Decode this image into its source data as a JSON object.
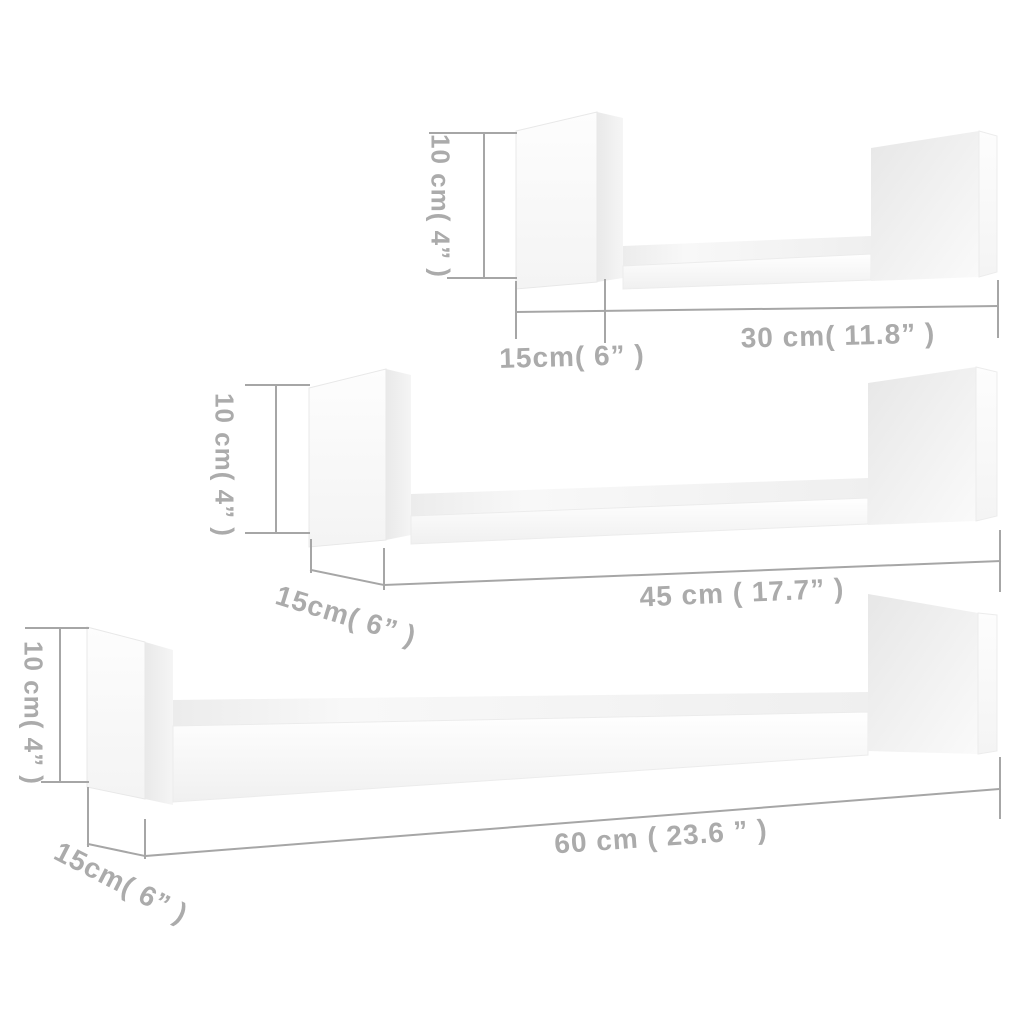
{
  "diagram_title": "Wall shelf set dimension diagram",
  "colors": {
    "background": "#ffffff",
    "dimension_line": "#a6a6a6",
    "label_text": "#ababab",
    "shelf_face": "#fbfbfb",
    "shelf_side_shade": "#ebebeb"
  },
  "shelves": [
    {
      "id": "shelf-small",
      "height_label": "10 cm( 4” )",
      "depth_label": "15cm( 6” )",
      "width_label": "30 cm( 11.8” )"
    },
    {
      "id": "shelf-medium",
      "height_label": "10 cm( 4” )",
      "depth_label": "15cm( 6” )",
      "width_label": "45 cm ( 17.7” )"
    },
    {
      "id": "shelf-large",
      "height_label": "10 cm( 4” )",
      "depth_label": "15cm( 6” )",
      "width_label": "60 cm  ( 23.6 ” )"
    }
  ]
}
